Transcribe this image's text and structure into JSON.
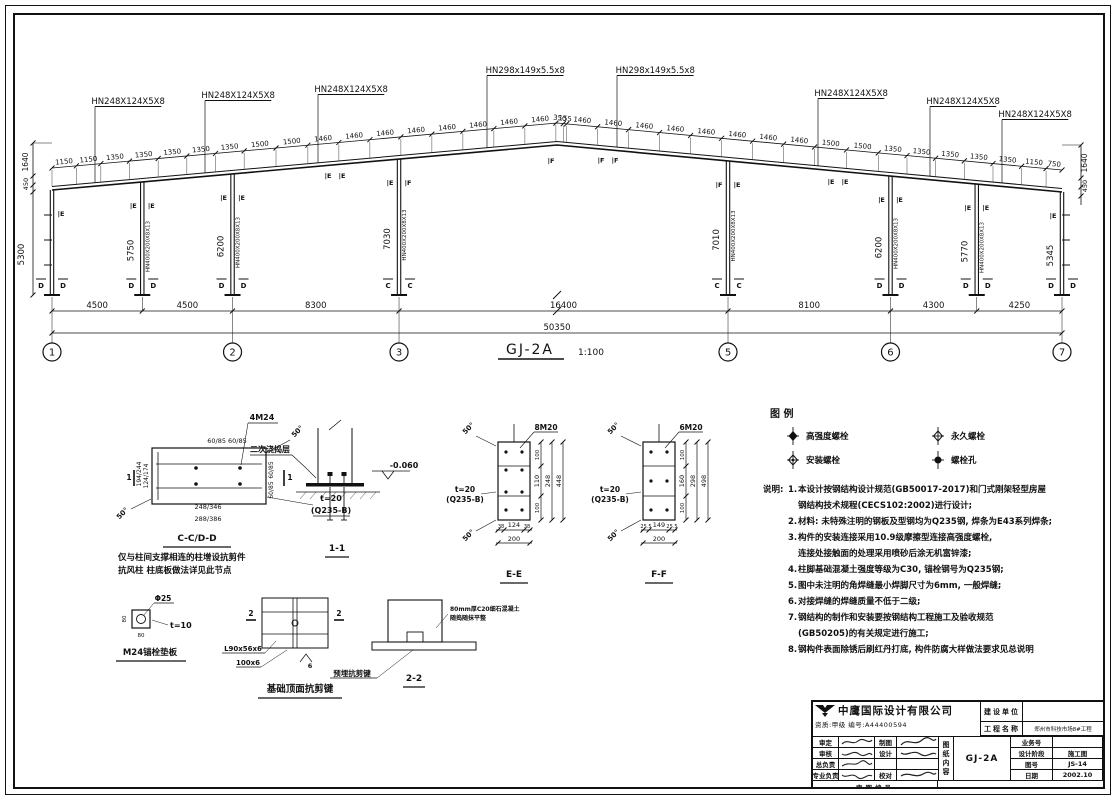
{
  "elevation": {
    "frame_title": "GJ-2A",
    "frame_scale": "1:100",
    "callouts_left": [
      "HN248X124X5X8",
      "HN248X124X5X8",
      "HN248X124X5X8"
    ],
    "callouts_ridge": [
      "HN298x149x5.5x8",
      "HN298x149x5.5x8"
    ],
    "callouts_right": [
      "HN248X124X5X8",
      "HN248X124X5X8",
      "HN248X124X5X8"
    ],
    "column_section": "HN400X200X8X13",
    "top_dims_left": [
      "1150",
      "1150",
      "1350",
      "1350",
      "1350",
      "1350",
      "1350",
      "1500",
      "1500",
      "1460",
      "1460",
      "1460",
      "1460",
      "1460",
      "1460",
      "1460",
      "1460"
    ],
    "ridge_dims": [
      "350",
      "155"
    ],
    "top_dims_right": [
      "1460",
      "1460",
      "1460",
      "1460",
      "1460",
      "1460",
      "1460",
      "1460",
      "1500",
      "1500",
      "1350",
      "1350",
      "1350",
      "1350",
      "1350",
      "1150",
      "750"
    ],
    "column_heights": [
      "5300",
      "5750",
      "6200",
      "7030",
      "7010",
      "6200",
      "5770",
      "5345"
    ],
    "edge_dims_left": [
      "1640",
      "450"
    ],
    "edge_dims_right": [
      "1640",
      "450"
    ],
    "top_marks": [
      [
        "",
        "E"
      ],
      [
        "E",
        "E"
      ],
      [
        "E",
        "E"
      ],
      [
        "E",
        "F"
      ],
      [
        "F",
        "E"
      ],
      [
        "E",
        "E"
      ],
      [
        "E",
        "E"
      ],
      [
        "E",
        ""
      ]
    ],
    "rafter_marks": [
      [
        "E",
        "E"
      ],
      [
        "F",
        "F"
      ],
      [
        "E",
        "E"
      ]
    ],
    "ridge_mark": "F",
    "base_marks": [
      [
        "D",
        "D"
      ],
      [
        "D",
        "D"
      ],
      [
        "D",
        "D"
      ],
      [
        "C",
        "C"
      ],
      [
        "C",
        "C"
      ],
      [
        "D",
        "D"
      ],
      [
        "D",
        "D"
      ],
      [
        "D",
        "D"
      ]
    ],
    "bay_dims": [
      "4500",
      "4500",
      "8300",
      "16400",
      "8100",
      "4300",
      "4250"
    ],
    "total_dim": "50350",
    "grid_bubbles": [
      "1",
      "2",
      "3",
      "5",
      "6",
      "7"
    ]
  },
  "details": {
    "cc_dd": {
      "bolts": "4M24",
      "top_dim": "60/85 60/85",
      "right_dims": [
        "60/85",
        "60/85"
      ],
      "left_dims": [
        "194/244",
        "124/174"
      ],
      "bottom_dims": [
        "248/346",
        "288/386"
      ],
      "plate": "t=20",
      "steel": "(Q235-B)",
      "angle": "50°",
      "cut_mark": "1",
      "title": "C-C/D-D",
      "note1": "仅与柱间支撑相连的柱增设抗剪件",
      "note2": "抗风柱 柱底板做法详见此节点"
    },
    "s11": {
      "layer": "二次浇捣层",
      "elev": "-0.060",
      "title": "1-1"
    },
    "ee": {
      "bolts": "8M20",
      "angle": "50°",
      "plate": "t=20",
      "steel": "(Q235-B)",
      "dim_top": "100",
      "dims_inner": "110",
      "dim_bot": "100",
      "dims_mid": "248",
      "dims_outer": "448",
      "bottom_dims": [
        "38",
        "124",
        "38"
      ],
      "bottom_total": "200",
      "title": "E-E"
    },
    "ff": {
      "bolts": "6M20",
      "angle": "50°",
      "plate": "t=20",
      "steel": "(Q235-B)",
      "dim_top": "100",
      "dims_inner": "160",
      "dim_bot": "100",
      "dims_mid": "298",
      "dims_outer": "498",
      "bottom_dims": [
        "25.5",
        "149",
        "25.5"
      ],
      "bottom_total": "200",
      "title": "F-F"
    },
    "washer": {
      "hole": "Φ25",
      "thick": "t=10",
      "dim": "80",
      "title": "M24锚栓垫板"
    },
    "shearkey": {
      "cut": "2",
      "label1": "L90x56x6",
      "label2": "100x6",
      "weld": "6",
      "title": "基础顶面抗剪键"
    },
    "s22": {
      "left_label": "预埋抗剪键",
      "right_label1": "80mm厚C20细石混凝土",
      "right_label2": "随捣随抹平整",
      "title": "2-2"
    }
  },
  "legend": {
    "header": "图 例",
    "items": [
      {
        "type": "hs",
        "label": "高强度螺栓"
      },
      {
        "type": "perm",
        "label": "永久螺栓"
      },
      {
        "type": "install",
        "label": "安装螺栓"
      },
      {
        "type": "hole",
        "label": "螺栓孔"
      }
    ]
  },
  "notes": {
    "header": "说明:",
    "items": [
      {
        "n": "1.",
        "lines": [
          "本设计按钢结构设计规范(GB50017-2017)和门式刚架轻型房屋",
          "钢结构技术规程(CECS102:2002)进行设计;"
        ]
      },
      {
        "n": "2.",
        "lines": [
          "材料: 未特殊注明的钢板及型钢均为Q235钢, 焊条为E43系列焊条;"
        ]
      },
      {
        "n": "3.",
        "lines": [
          "构件的安装连接采用10.9级摩擦型连接高强度螺栓,",
          "连接处接触面的处理采用喷砂后涂无机富锌漆;"
        ]
      },
      {
        "n": "4.",
        "lines": [
          "柱脚基础混凝土强度等级为C30, 锚栓钢号为Q235钢;"
        ]
      },
      {
        "n": "5.",
        "lines": [
          "图中未注明的角焊缝最小焊脚尺寸为6mm, 一般焊缝;"
        ]
      },
      {
        "n": "6.",
        "lines": [
          "对接焊缝的焊缝质量不低于二级;"
        ]
      },
      {
        "n": "7.",
        "lines": [
          "钢结构的制作和安装要按钢结构工程施工及验收规范",
          "(GB50205)的有关规定进行施工;"
        ]
      },
      {
        "n": "8.",
        "lines": [
          "钢构件表面除锈后刷红丹打底, 构件防腐大样做法要求见总说明"
        ]
      }
    ]
  },
  "titleblock": {
    "company": "中鹰国际设计有限公司",
    "cert": "资质:甲级  编号:A44400594",
    "owner_label": "建设单位",
    "owner_value": "",
    "project_label": "工程名称",
    "project_value": "郑州市科技市场8#工程",
    "left_rows": [
      [
        "审定",
        "制图"
      ],
      [
        "审核",
        "设计"
      ],
      [
        "总负责",
        ""
      ],
      [
        "专业负责",
        "校对"
      ]
    ],
    "right_rows": [
      [
        "业务号",
        ""
      ],
      [
        "设计阶段",
        "施工图"
      ],
      [
        "图号",
        "JS-14"
      ],
      [
        "日期",
        "2002.10"
      ]
    ],
    "content_label": "图纸内容",
    "content_value": "GJ-2A",
    "bottom_label": "审图编号"
  }
}
